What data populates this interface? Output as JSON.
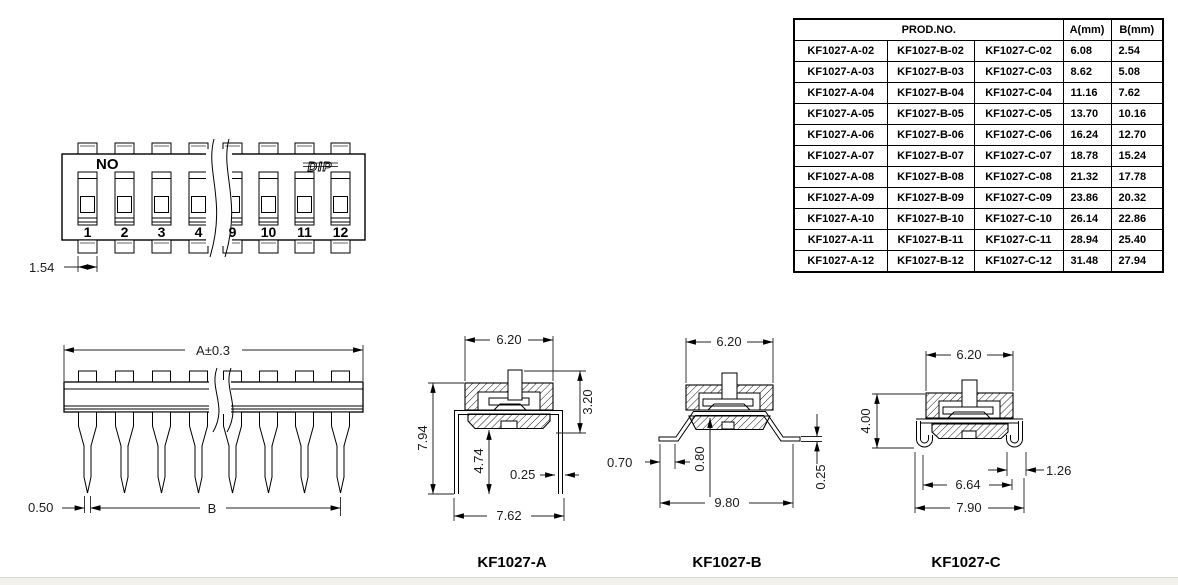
{
  "table": {
    "prod_no_header": "PROD.NO.",
    "col_a_header": "A(mm)",
    "col_b_header": "B(mm)",
    "rows": [
      [
        "KF1027-A-02",
        "KF1027-B-02",
        "KF1027-C-02",
        "6.08",
        "2.54"
      ],
      [
        "KF1027-A-03",
        "KF1027-B-03",
        "KF1027-C-03",
        "8.62",
        "5.08"
      ],
      [
        "KF1027-A-04",
        "KF1027-B-04",
        "KF1027-C-04",
        "11.16",
        "7.62"
      ],
      [
        "KF1027-A-05",
        "KF1027-B-05",
        "KF1027-C-05",
        "13.70",
        "10.16"
      ],
      [
        "KF1027-A-06",
        "KF1027-B-06",
        "KF1027-C-06",
        "16.24",
        "12.70"
      ],
      [
        "KF1027-A-07",
        "KF1027-B-07",
        "KF1027-C-07",
        "18.78",
        "15.24"
      ],
      [
        "KF1027-A-08",
        "KF1027-B-08",
        "KF1027-C-08",
        "21.32",
        "17.78"
      ],
      [
        "KF1027-A-09",
        "KF1027-B-09",
        "KF1027-C-09",
        "23.86",
        "20.32"
      ],
      [
        "KF1027-A-10",
        "KF1027-B-10",
        "KF1027-C-10",
        "26.14",
        "22.86"
      ],
      [
        "KF1027-A-11",
        "KF1027-B-11",
        "KF1027-C-11",
        "28.94",
        "25.40"
      ],
      [
        "KF1027-A-12",
        "KF1027-B-12",
        "KF1027-C-12",
        "31.48",
        "27.94"
      ]
    ]
  },
  "front_view": {
    "orientation_label": "NO",
    "brand_logo_text": "DIP",
    "position_labels": [
      "1",
      "2",
      "3",
      "4",
      "9",
      "10",
      "11",
      "12"
    ],
    "pitch_dim": "1.54"
  },
  "side_view": {
    "width_dim": "A±0.3",
    "span_dim": "B",
    "pin_tip_dim": "0.50"
  },
  "sections": {
    "a": {
      "label": "KF1027-A",
      "top_width": "6.20",
      "total_height": "7.94",
      "pin_height": "4.74",
      "body_height": "3.20",
      "pin_thickness": "0.25",
      "bottom_width": "7.62"
    },
    "b": {
      "label": "KF1027-B",
      "top_width": "6.20",
      "foot_length": "0.70",
      "standoff": "0.80",
      "pin_thickness": "0.25",
      "bottom_width": "9.80"
    },
    "c": {
      "label": "KF1027-C",
      "top_width": "6.20",
      "body_height": "4.00",
      "lead_width": "1.26",
      "inner_span": "6.64",
      "bottom_width": "7.90"
    }
  }
}
